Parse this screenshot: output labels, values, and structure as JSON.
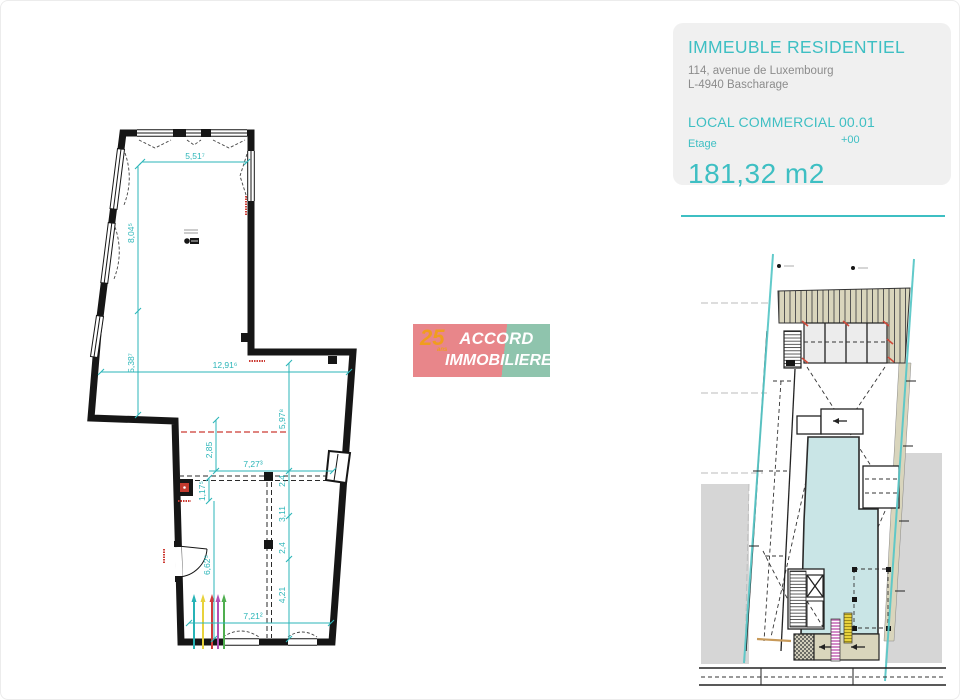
{
  "colors": {
    "teal": "#3ebfc3",
    "dim": "#2bb5b8",
    "gray-text": "#8c8c8c",
    "panel-bg": "#f0f0f0",
    "logo-pink": "#e8868a",
    "logo-green": "#8fc4ad",
    "logo-orange": "#f09d1e",
    "wall": "#161616",
    "red": "#cc3b33",
    "site-teal-fill": "#c9e5e6",
    "site-beige": "#d9d5bc",
    "site-gray": "#d6d6d6",
    "boundary-teal": "#5ac7c7",
    "riser-teal": "#27b3b6",
    "riser-yellow": "#e8d23c",
    "riser-red": "#d23a3a",
    "riser-magenta": "#b44fb4",
    "riser-green": "#4fae4f"
  },
  "header": {
    "title": "IMMEUBLE RESIDENTIEL",
    "address_line1": "114, avenue de Luxembourg",
    "address_line2": "L-4940 Bascharage",
    "unit_label": "LOCAL COMMERCIAL 00.01",
    "floor_label": "Etage",
    "floor_value": "+00",
    "area": "181,32 m2"
  },
  "logo": {
    "badge": "25",
    "badge_sub": "ans",
    "line1": "ACCORD",
    "line2": "IMMOBILIERE"
  },
  "main_plan": {
    "dims": {
      "top_width": "5,51⁷",
      "left_upper": "8,04⁵",
      "left_lower": "5,38⁷",
      "mid_width": "12,91⁶",
      "right_upper": "5,97⁸",
      "center_small": "2,85",
      "inner_width": "7,27³",
      "right_small_1": "2,4",
      "left_small": "1,17⁵",
      "right_mid": "3,11",
      "right_small_2": "2,4",
      "right_lower": "4,21",
      "left_room_height": "6,62⁵",
      "bottom_width": "7,21²"
    }
  }
}
